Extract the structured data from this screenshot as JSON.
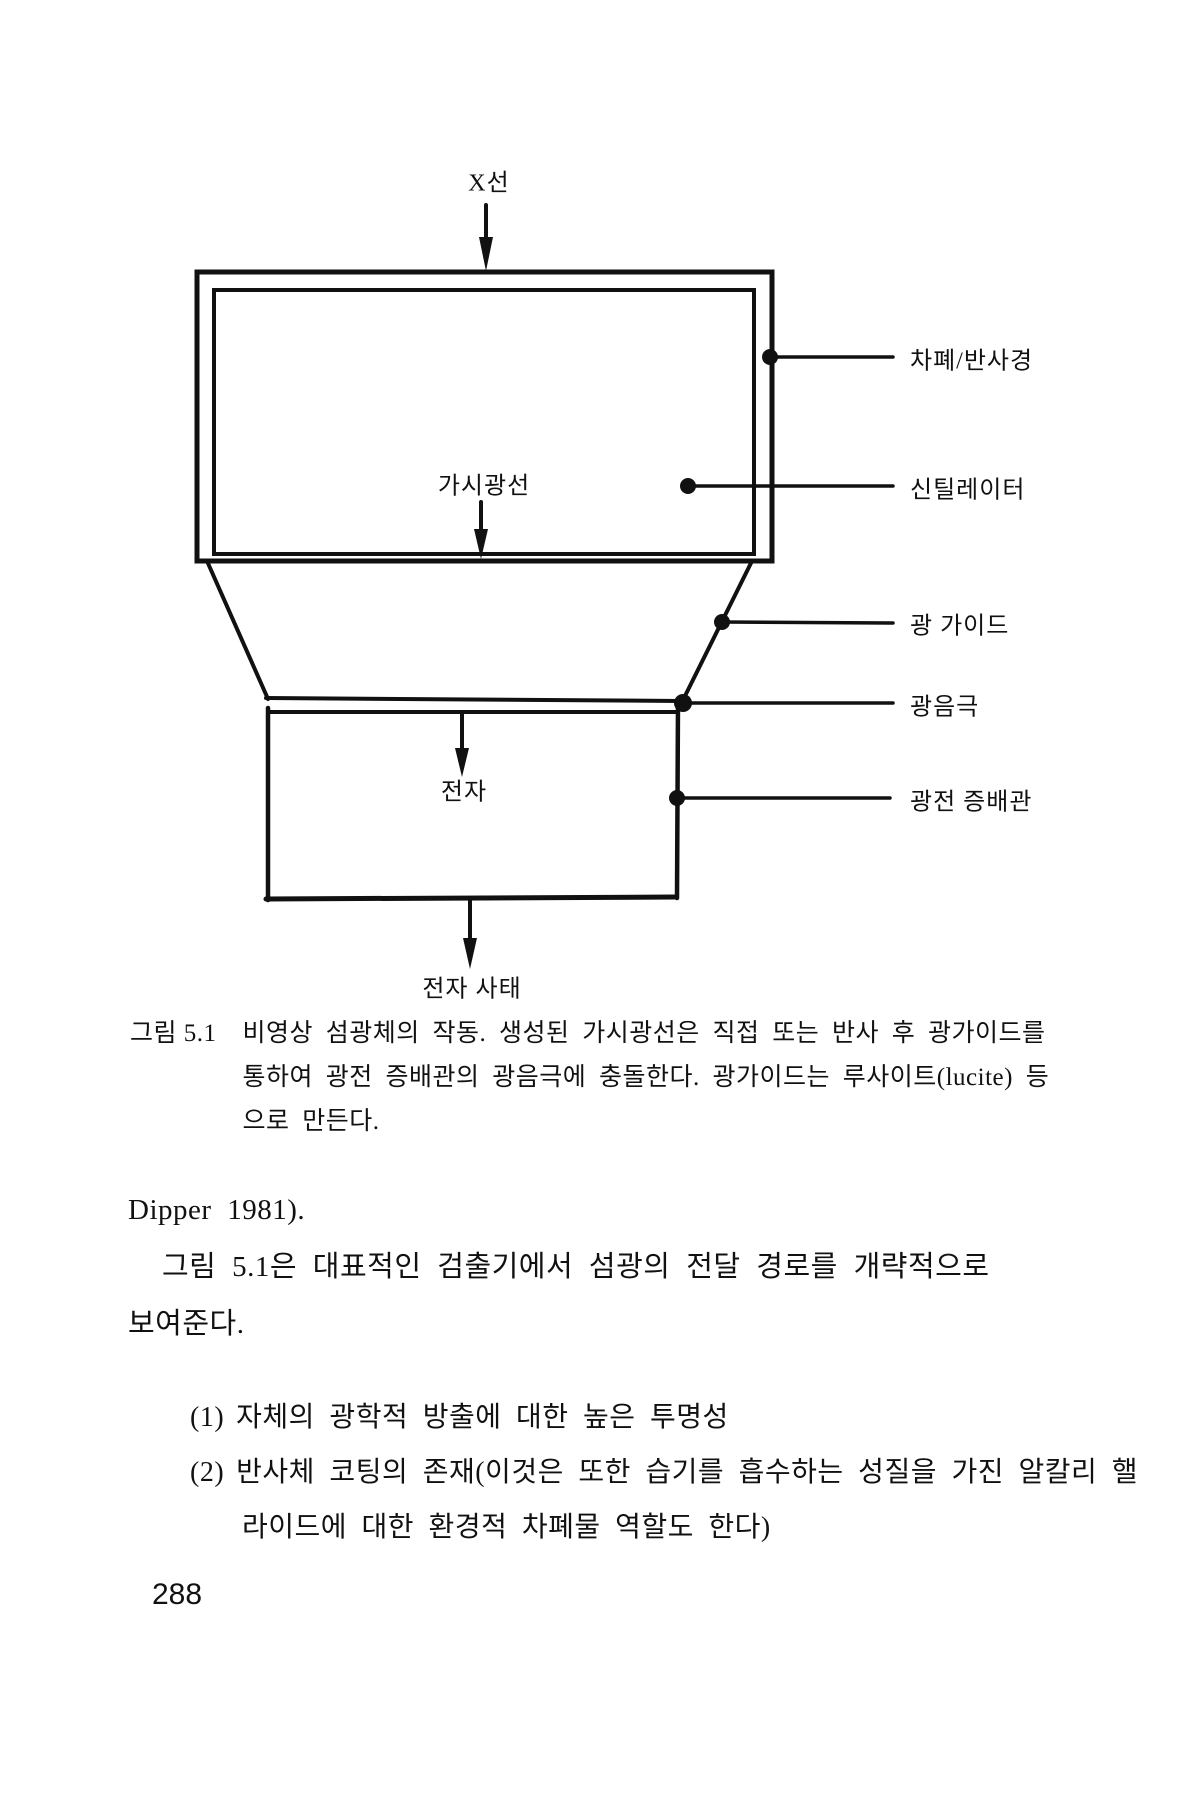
{
  "figure": {
    "labels": {
      "xray": "X선",
      "visible_light": "가시광선",
      "electron": "전자",
      "electron_avalanche": "전자 사태",
      "shield_reflector": "차폐/반사경",
      "scintillator": "신틸레이터",
      "light_guide": "광 가이드",
      "photocathode": "광음극",
      "photomultiplier": "광전 증배관"
    },
    "caption": {
      "tag": "그림 5.1",
      "line1": "비영상 섬광체의 작동. 생성된 가시광선은 직접 또는 반사 후 광가이드를",
      "line2": "통하여 광전 증배관의 광음극에 충돌한다. 광가이드는 루사이트(lucite) 등",
      "line3": "으로 만든다."
    }
  },
  "body": {
    "para1": "Dipper 1981).",
    "para2_line1": "그림 5.1은 대표적인 검출기에서 섬광의 전달 경로를 개략적으로",
    "para2_line2": "보여준다.",
    "list": [
      {
        "marker": "(1)",
        "line1": "자체의 광학적 방출에 대한 높은 투명성",
        "line2": ""
      },
      {
        "marker": "(2)",
        "line1": "반사체 코팅의 존재(이것은 또한 습기를 흡수하는 성질을 가진 알칼리 핼",
        "line2": "라이드에 대한 환경적 차폐물 역할도 한다)"
      }
    ]
  },
  "page": {
    "number": "288"
  },
  "colors": {
    "ink": "#111111",
    "paper": "#ffffff"
  }
}
